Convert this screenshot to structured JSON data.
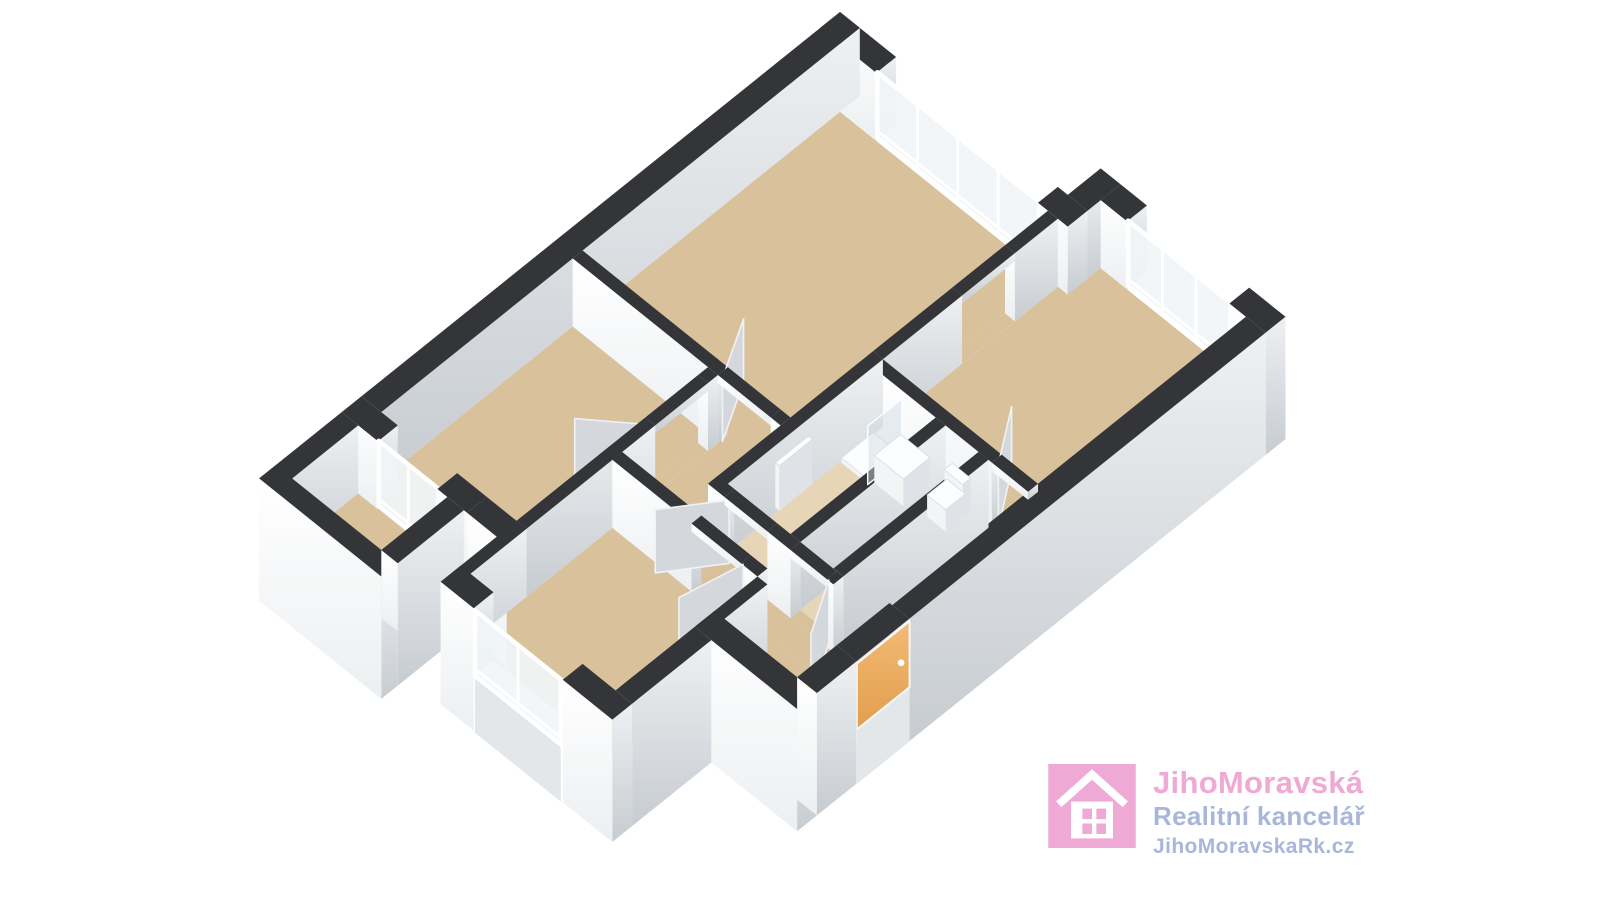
{
  "branding": {
    "company": "JihoMoravská",
    "tagline": "Realitní kancelář",
    "website": "JihoMoravskaRk.cz",
    "colors": {
      "pink": "#efa9d5",
      "blue": "#a8b6d9",
      "icon_white": "#ffffff"
    }
  },
  "palette": {
    "background": "#ffffff",
    "wall_cap": "#333539",
    "wall_face_light_top": "#ffffff",
    "wall_face_light_bottom": "#eceff1",
    "wall_face_shade_top": "#eef0f2",
    "wall_face_shade_bottom": "#c7ccd1",
    "skirt": "#e4e7ea",
    "floor_tan": "#d8c19b",
    "floor_light": "#e6d5b7",
    "glass": "#f1f5f7",
    "frame": "#ffffff",
    "door_leaf": "#d4d8dc",
    "door_leaf_edge": "#f0f2f4",
    "entry_door_top": "#f2ba74",
    "entry_door_bottom": "#e29e4e",
    "fixture_top": "#fcfdfe",
    "fixture_side_shade": "#dfe3e7",
    "fixture_side_light": "#f2f4f6",
    "shower_pane": "#cfdae0"
  },
  "plan": {
    "projection": {
      "x0": 840,
      "y0": 80,
      "k": 66,
      "ks": 53,
      "h": 68
    },
    "elements": [
      {
        "n": "floor-living",
        "t": "floor",
        "r": [
          0.3,
          0.3,
          3.45,
          4.2
        ]
      },
      {
        "n": "floor-kitchen",
        "t": "floor",
        "r": [
          3.6,
          -0.2,
          5.95,
          2.95
        ]
      },
      {
        "n": "floor-hall-west",
        "t": "floor",
        "r": [
          2.5,
          4.2,
          3.45,
          5.8
        ]
      },
      {
        "n": "floor-hall-south",
        "t": "floor",
        "r": [
          3.45,
          5.45,
          5.95,
          5.8
        ]
      },
      {
        "n": "floor-hall-east",
        "t": "floor",
        "r": [
          5.35,
          2.95,
          5.95,
          5.45
        ]
      },
      {
        "n": "floor-entry-vestibule",
        "t": "floor",
        "r": [
          4.7,
          5.8,
          5.95,
          6.6
        ]
      },
      {
        "n": "floor-bedroom-1",
        "t": "floor",
        "r": [
          0.3,
          4.35,
          2.35,
          7.25
        ]
      },
      {
        "n": "floor-bedroom-2",
        "t": "floor",
        "r": [
          2.5,
          5.95,
          4.7,
          8.1
        ]
      },
      {
        "n": "floor-bathroom",
        "t": "floor",
        "r": [
          3.6,
          3.1,
          4.55,
          5.3
        ],
        "c": "light"
      },
      {
        "n": "floor-wc",
        "t": "floor",
        "r": [
          4.7,
          3.1,
          5.2,
          5.3
        ],
        "c": "light"
      },
      {
        "n": "floor-balcony",
        "t": "floor",
        "r": [
          0.25,
          7.55,
          1.6,
          8.55
        ]
      },
      {
        "n": "threshold-living",
        "t": "floor",
        "r": [
          2.5,
          4.2,
          3.3,
          4.35
        ]
      },
      {
        "n": "threshold-bedroom-1",
        "t": "floor",
        "r": [
          2.35,
          4.5,
          2.5,
          5.3
        ]
      },
      {
        "n": "threshold-bathroom",
        "t": "floor",
        "r": [
          3.7,
          5.3,
          4.35,
          5.45
        ]
      },
      {
        "n": "threshold-wc",
        "t": "floor",
        "r": [
          4.7,
          5.3,
          5.25,
          5.45
        ]
      },
      {
        "n": "threshold-bedroom-2",
        "t": "floor",
        "r": [
          3.7,
          5.8,
          4.45,
          5.95
        ]
      },
      {
        "n": "threshold-kitchen",
        "t": "floor",
        "r": [
          5.4,
          2.95,
          5.9,
          3.1
        ]
      },
      {
        "n": "threshold-living-kitchen",
        "t": "floor",
        "r": [
          3.45,
          0.95,
          3.6,
          1.75
        ]
      },
      {
        "n": "threshold-balcony",
        "t": "floor",
        "r": [
          0.55,
          7.25,
          1.45,
          7.55
        ]
      },
      {
        "n": "wall-living-ne-left",
        "t": "wall",
        "r": [
          0.0,
          0.0,
          0.85,
          0.3
        ]
      },
      {
        "n": "window-living",
        "t": "win",
        "a": [
          0.85,
          0.285
        ],
        "b": [
          3.3,
          0.285
        ],
        "m": [
          1.46,
          2.07,
          2.68
        ]
      },
      {
        "n": "wall-living-ne-right",
        "t": "wall",
        "r": [
          3.3,
          0.0,
          3.75,
          0.3
        ]
      },
      {
        "n": "wall-step",
        "t": "wall",
        "r": [
          3.45,
          -0.5,
          3.75,
          0.0
        ]
      },
      {
        "n": "wall-kitchen-ne-left",
        "t": "wall",
        "r": [
          3.75,
          -0.5,
          4.15,
          -0.2
        ]
      },
      {
        "n": "window-kitchen",
        "t": "win",
        "a": [
          4.15,
          -0.215
        ],
        "b": [
          5.7,
          -0.215
        ],
        "m": [
          4.67,
          5.18
        ]
      },
      {
        "n": "wall-kitchen-ne-right",
        "t": "wall",
        "r": [
          5.7,
          -0.5,
          6.25,
          -0.2
        ],
        "fu": -0.8
      },
      {
        "n": "wall-se-upper",
        "t": "wall",
        "r": [
          5.95,
          -0.2,
          6.25,
          5.2
        ],
        "fu": -0.8
      },
      {
        "n": "lintel-entry",
        "t": "wall",
        "r": [
          5.95,
          5.2,
          6.25,
          6.0
        ],
        "zb": 0.88
      },
      {
        "n": "entry-door",
        "t": "edoor",
        "u": 6.255,
        "v1": 5.2,
        "v2": 6.0,
        "zt": 0.97
      },
      {
        "n": "wall-se-lower",
        "t": "wall",
        "r": [
          5.95,
          6.0,
          6.25,
          6.6
        ],
        "fu": -0.8,
        "fv": -0.8
      },
      {
        "n": "wall-nw-outer",
        "t": "wall",
        "r": [
          0.0,
          0.0,
          0.3,
          7.25
        ]
      },
      {
        "n": "wall-bedroom1-sw-left",
        "t": "wall",
        "r": [
          0.0,
          7.25,
          0.55,
          7.55
        ]
      },
      {
        "n": "window-balcony-door",
        "t": "win",
        "a": [
          0.55,
          7.54
        ],
        "b": [
          1.45,
          7.54
        ],
        "m": [
          1.0
        ]
      },
      {
        "n": "wall-bedroom1-sw-mid",
        "t": "wall",
        "r": [
          1.45,
          7.25,
          1.9,
          7.55
        ]
      },
      {
        "n": "wall-bedroom1-sw-right",
        "t": "wall",
        "r": [
          1.9,
          7.25,
          2.5,
          7.55
        ],
        "fv": -0.8
      },
      {
        "n": "wall-balcony-nw",
        "t": "wall",
        "r": [
          0.0,
          7.55,
          0.25,
          8.8
        ],
        "fv": -0.8
      },
      {
        "n": "wall-balcony-sw",
        "t": "wall",
        "r": [
          0.0,
          8.55,
          1.85,
          8.8
        ],
        "fv": -0.8,
        "fu": -0.8
      },
      {
        "n": "wall-balcony-se",
        "t": "wall",
        "r": [
          1.6,
          7.55,
          1.85,
          8.55
        ],
        "fu": -0.8
      },
      {
        "n": "wall-bedroom2-nw",
        "t": "wall",
        "r": [
          2.35,
          7.25,
          2.5,
          8.4
        ],
        "fv": -0.8
      },
      {
        "n": "wall-bedroom2-sw-left",
        "t": "wall",
        "r": [
          2.35,
          8.1,
          2.85,
          8.4
        ],
        "fv": -0.8
      },
      {
        "n": "window-bedroom2",
        "t": "win",
        "a": [
          2.88,
          8.41
        ],
        "b": [
          4.18,
          8.41
        ],
        "m": [
          3.53
        ],
        "skirt": true
      },
      {
        "n": "wall-bedroom2-sw-right",
        "t": "wall",
        "r": [
          4.2,
          8.1,
          4.95,
          8.4
        ],
        "fv": -0.8,
        "fu": -0.8
      },
      {
        "n": "wall-bedroom2-se",
        "t": "wall",
        "r": [
          4.7,
          6.9,
          4.95,
          8.1
        ],
        "fu": -0.8
      },
      {
        "n": "wall-hall-sw",
        "t": "wall",
        "r": [
          4.7,
          6.6,
          6.25,
          6.9
        ],
        "fu": -0.8,
        "fv": -0.8
      },
      {
        "n": "wall-living-bedroom1",
        "t": "wall",
        "r": [
          0.3,
          4.2,
          2.5,
          4.35
        ]
      },
      {
        "n": "lintel-living-door",
        "t": "wall",
        "r": [
          2.5,
          4.2,
          3.3,
          4.35
        ],
        "zb": 0.88
      },
      {
        "n": "wall-living-hall",
        "t": "wall",
        "r": [
          3.3,
          4.2,
          3.45,
          4.35
        ]
      },
      {
        "n": "wall-bedroom1-se-top",
        "t": "wall",
        "r": [
          2.35,
          4.35,
          2.5,
          4.5
        ]
      },
      {
        "n": "lintel-bedroom1-door",
        "t": "wall",
        "r": [
          2.35,
          4.5,
          2.5,
          5.3
        ],
        "zb": 0.88
      },
      {
        "n": "wall-bedroom1-se",
        "t": "wall",
        "r": [
          2.35,
          5.3,
          2.5,
          7.25
        ]
      },
      {
        "n": "wall-living-kitchen-top",
        "t": "wall",
        "r": [
          3.45,
          0.3,
          3.6,
          0.95
        ]
      },
      {
        "n": "lintel-living-kitchen",
        "t": "wall",
        "r": [
          3.45,
          0.95,
          3.6,
          1.75
        ],
        "zb": 0.88
      },
      {
        "n": "wall-living-kitchen-bot",
        "t": "wall",
        "r": [
          3.45,
          1.75,
          3.6,
          2.95
        ]
      },
      {
        "n": "wall-kitchen-sw",
        "t": "wall",
        "r": [
          3.6,
          2.95,
          5.4,
          3.1
        ]
      },
      {
        "n": "lintel-kitchen-door",
        "t": "wall",
        "r": [
          5.4,
          2.95,
          5.95,
          3.1
        ],
        "zb": 0.88
      },
      {
        "n": "wall-bath-nw",
        "t": "wall",
        "r": [
          3.45,
          2.95,
          3.6,
          5.45
        ]
      },
      {
        "n": "wall-bath-wc-divider",
        "t": "wall",
        "r": [
          4.55,
          3.1,
          4.7,
          5.3
        ]
      },
      {
        "n": "wall-wc-se",
        "t": "wall",
        "r": [
          5.2,
          3.1,
          5.35,
          5.3
        ]
      },
      {
        "n": "wall-bath-sw-left",
        "t": "wall",
        "r": [
          3.45,
          5.3,
          3.7,
          5.45
        ]
      },
      {
        "n": "lintel-bath-door",
        "t": "wall",
        "r": [
          3.7,
          5.3,
          4.35,
          5.45
        ],
        "zb": 0.88
      },
      {
        "n": "wall-bath-sw-mid",
        "t": "wall",
        "r": [
          4.35,
          5.3,
          4.7,
          5.45
        ]
      },
      {
        "n": "lintel-wc-door",
        "t": "wall",
        "r": [
          4.7,
          5.3,
          5.25,
          5.45
        ],
        "zb": 0.88
      },
      {
        "n": "wall-bath-sw-right",
        "t": "wall",
        "r": [
          5.25,
          5.3,
          5.35,
          5.45
        ]
      },
      {
        "n": "wall-bedroom2-ne-left",
        "t": "wall",
        "r": [
          2.5,
          5.8,
          3.7,
          5.95
        ]
      },
      {
        "n": "lintel-bedroom2-door",
        "t": "wall",
        "r": [
          3.7,
          5.8,
          4.45,
          5.95
        ],
        "zb": 0.88
      },
      {
        "n": "wall-bedroom2-ne-right",
        "t": "wall",
        "r": [
          4.45,
          5.8,
          4.7,
          5.95
        ]
      },
      {
        "n": "wall-vestibule-bedroom2",
        "t": "wall",
        "r": [
          4.7,
          5.95,
          4.85,
          6.9
        ]
      },
      {
        "n": "door-living",
        "t": "leaf",
        "a": [
          2.52,
          4.3
        ],
        "b": [
          2.12,
          3.58
        ]
      },
      {
        "n": "door-bedroom-1",
        "t": "leaf",
        "a": [
          2.42,
          5.28
        ],
        "b": [
          1.78,
          5.8
        ]
      },
      {
        "n": "door-bedroom-2",
        "t": "leaf",
        "a": [
          4.43,
          5.9
        ],
        "b": [
          4.26,
          6.7
        ]
      },
      {
        "n": "door-bathroom",
        "t": "leaf",
        "a": [
          3.72,
          5.4
        ],
        "b": [
          3.25,
          6.05
        ]
      },
      {
        "n": "door-wc",
        "t": "leaf",
        "a": [
          5.23,
          5.4
        ],
        "b": [
          5.6,
          6.04
        ]
      },
      {
        "n": "door-kitchen",
        "t": "leaf",
        "a": [
          5.42,
          3.02
        ],
        "b": [
          4.98,
          2.38
        ]
      },
      {
        "n": "fixture-shower-tray",
        "t": "box",
        "r": [
          3.62,
          3.12,
          4.02,
          3.6
        ],
        "zb": 0,
        "zt": 0.07,
        "bias": 1.0
      },
      {
        "n": "fixture-shower-glass",
        "t": "pane",
        "a": [
          4.04,
          3.1
        ],
        "b": [
          4.04,
          3.62
        ],
        "zb": 0.02,
        "zt": 0.88,
        "bias": 1.6
      },
      {
        "n": "fixture-vanity",
        "t": "box",
        "r": [
          4.06,
          3.14,
          4.5,
          3.54
        ],
        "zb": 0,
        "zt": 0.4,
        "bias": 1.5
      },
      {
        "n": "fixture-radiator",
        "t": "box",
        "r": [
          3.62,
          4.1,
          3.68,
          4.6
        ],
        "zb": 0.12,
        "zt": 0.78,
        "bias": 1.5
      },
      {
        "n": "fixture-toilet",
        "t": "box",
        "r": [
          4.78,
          3.16,
          5.06,
          3.46
        ],
        "zb": 0,
        "zt": 0.32,
        "bias": 1.5
      },
      {
        "n": "fixture-cistern",
        "t": "box",
        "r": [
          4.8,
          3.1,
          5.08,
          3.22
        ],
        "zb": 0,
        "zt": 0.52,
        "bias": 1.5
      }
    ]
  }
}
